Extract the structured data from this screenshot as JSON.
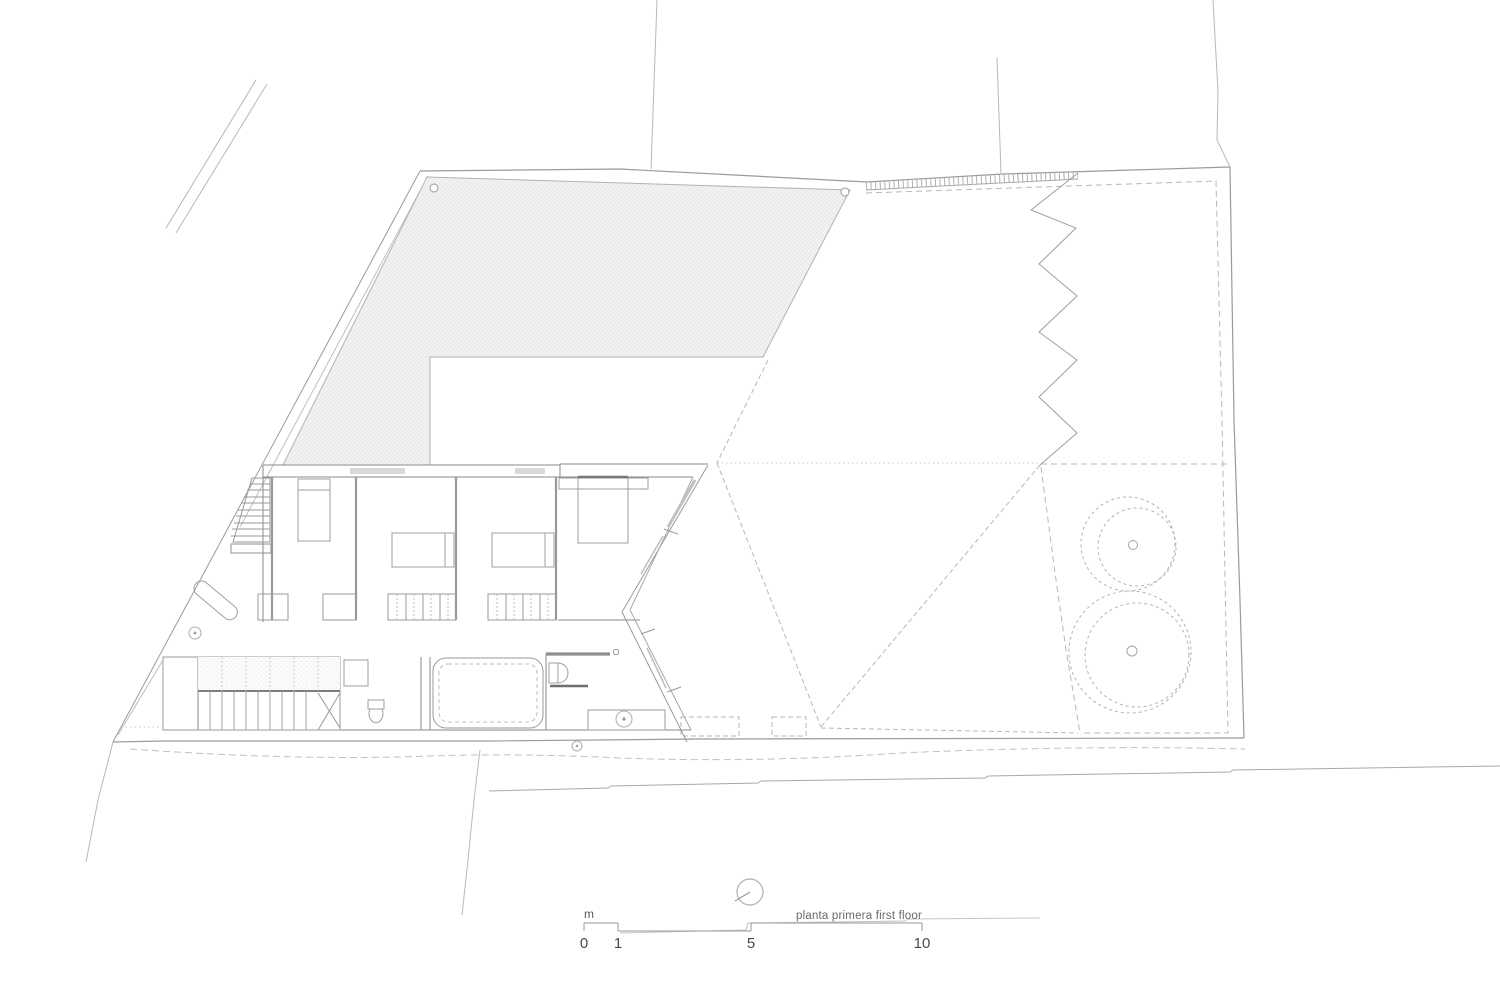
{
  "plan": {
    "title": "planta primera first floor"
  },
  "scale_bar": {
    "unit": "m",
    "ticks": [
      "0",
      "1",
      "5",
      "10"
    ]
  },
  "colors": {
    "background": "#ffffff",
    "wall_line": "#8a8a8a",
    "light_line": "#b5b5b5",
    "dashed_line": "#b8b8b8",
    "dark_accent": "#6e6e6e",
    "hatch_dot": "#dcdcda",
    "hatch_background": "#f2f2f1",
    "text": "#4f4f4f"
  },
  "symbols": {
    "north_arrow": "north-arrow-circle",
    "trees": "dashed tree canopies with trunks",
    "zigzag": "zigzag retaining wall",
    "roof_hatch": "dotted roof terrace hatch"
  }
}
